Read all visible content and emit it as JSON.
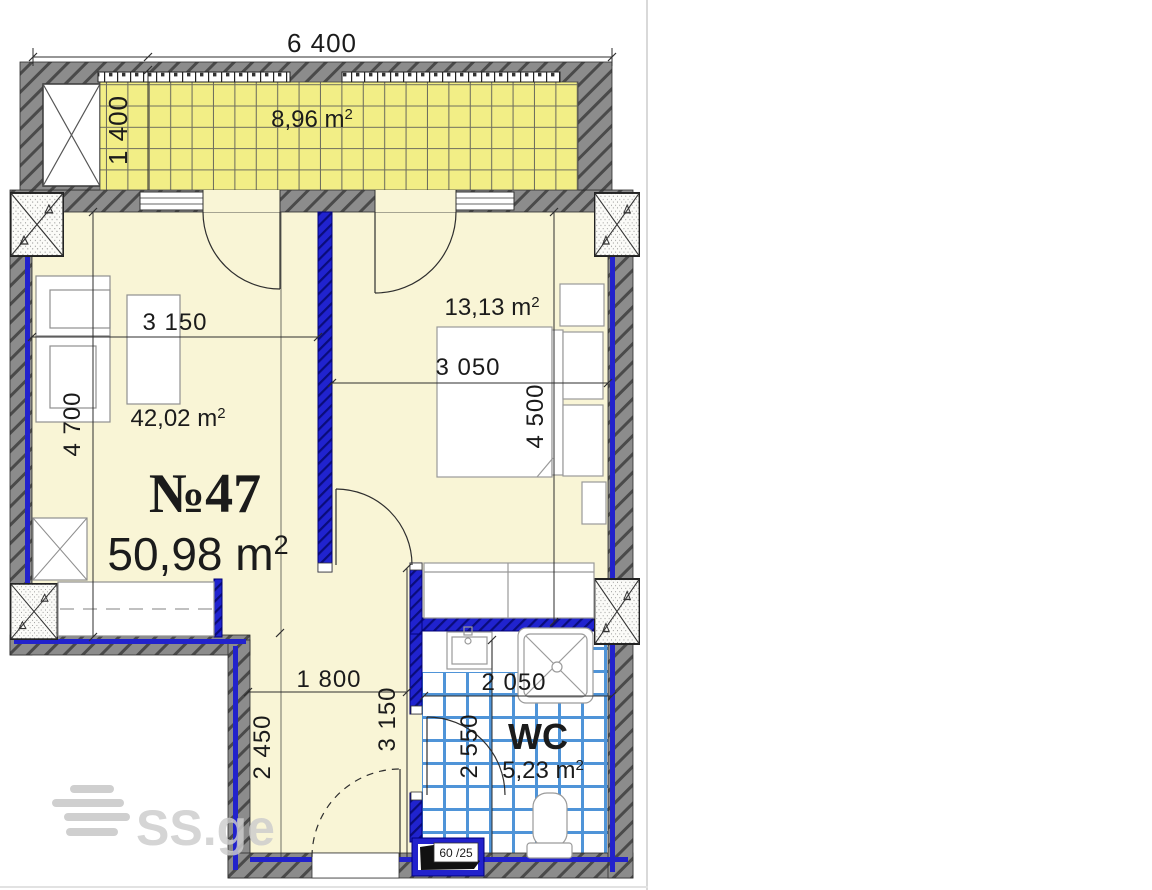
{
  "page": {
    "watermark": "SS.ge"
  },
  "colors": {
    "unit_red": "#c42020",
    "wall_gray": "#8c8c8c",
    "partition_blue": "#2222cc",
    "tile_blue": "#4f94d8",
    "balcony_yellow": "#f2ee86",
    "floor_cream": "#f9f5d6",
    "dim_text": "#1b1b1b",
    "watermark_gray": "#cccccc"
  },
  "unit": {
    "number": "№47",
    "area_value": "50,98 m",
    "sup": "2"
  },
  "balcony": {
    "area_value": "8,96 m",
    "sup": "2",
    "dim_width": "6 400",
    "dim_depth": "1 400"
  },
  "living_room": {
    "area_value": "42,02 m",
    "sup": "2",
    "dim_width": "3 150",
    "dim_depth": "4 700"
  },
  "bedroom": {
    "area_value": "13,13 m",
    "sup": "2",
    "dim_width": "3 050",
    "dim_depth": "4 500"
  },
  "hallway": {
    "dim_width": "1 800",
    "dim_depth": "2 450",
    "dim_depth_right": "3 150"
  },
  "wc": {
    "name": "WC",
    "area_value": "5,23 m",
    "sup": "2",
    "dim_width": "2 050",
    "dim_depth": "2 550"
  },
  "vent_shaft": {
    "label": "60 /25"
  }
}
